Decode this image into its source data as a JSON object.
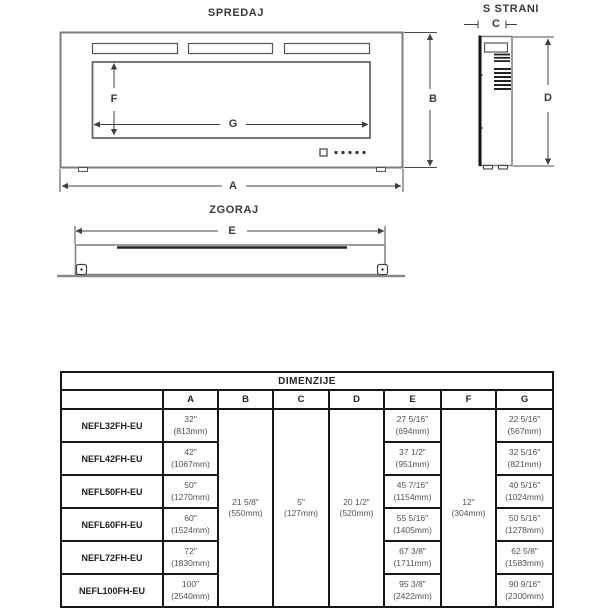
{
  "front_view": {
    "title": "SPREDAJ",
    "dim_a": "A",
    "dim_b": "B",
    "dim_f": "F",
    "dim_g": "G"
  },
  "side_view": {
    "title": "S STRANI",
    "dim_c": "C",
    "dim_d": "D"
  },
  "top_view": {
    "title": "ZGORAJ",
    "dim_e": "E"
  },
  "table": {
    "title": "DIMENZIJE",
    "model_header": "",
    "columns": [
      "A",
      "B",
      "C",
      "D",
      "E",
      "F",
      "G"
    ],
    "shared": {
      "B": "21 5/8\"\n(550mm)",
      "C": "5\"\n(127mm)",
      "D": "20 1/2\"\n(520mm)",
      "F": "12\"\n(304mm)"
    },
    "rows": [
      {
        "model": "NEFL32FH-EU",
        "A": "32\"\n(813mm)",
        "E": "27 5/16\"\n(694mm)",
        "G": "22 5/16\"\n(567mm)"
      },
      {
        "model": "NEFL42FH-EU",
        "A": "42\"\n(1067mm)",
        "E": "37 1/2\"\n(951mm)",
        "G": "32 5/16\"\n(821mm)"
      },
      {
        "model": "NEFL50FH-EU",
        "A": "50\"\n(1270mm)",
        "E": "45 7/16\"\n(1154mm)",
        "G": "40 5/16\"\n(1024mm)"
      },
      {
        "model": "NEFL60FH-EU",
        "A": "60\"\n(1524mm)",
        "E": "55 5/16\"\n(1405mm)",
        "G": "50 5/16\"\n(1278mm)"
      },
      {
        "model": "NEFL72FH-EU",
        "A": "72\"\n(1830mm)",
        "E": "67 3/8\"\n(1711mm)",
        "G": "62 5/8\"\n(1583mm)"
      },
      {
        "model": "NEFL100FH-EU",
        "A": "100\"\n(2540mm)",
        "E": "95 3/8\"\n(2422mm)",
        "G": "90 9/16\"\n(2300mm)"
      }
    ]
  },
  "colors": {
    "dimension_line": "#3f3f3f",
    "outline_gray": "#7d7d7d",
    "hatch_dark": "#222222",
    "table_border": "#161616",
    "value_text": "#525252",
    "label_text": "#3a3a3a",
    "background": "#ffffff"
  }
}
